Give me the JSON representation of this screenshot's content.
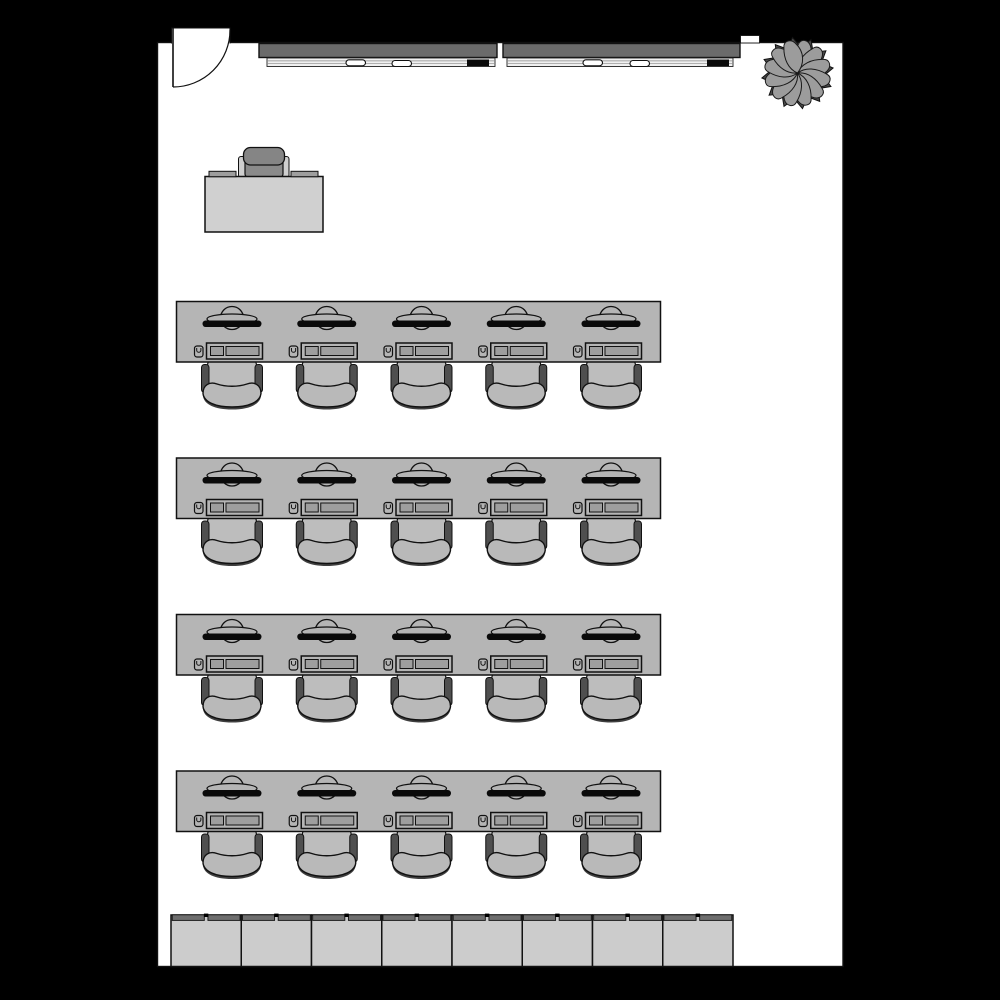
{
  "scene": {
    "title": "Computer classroom floor plan",
    "background_color": "#000000",
    "room_fill": "#ffffff",
    "outline_color": "#111111"
  },
  "palette": {
    "table_gray": "#b5b5b5",
    "desk_gray": "#d0d0d0",
    "seat_gray": "#bdbdbd",
    "crescent_gray": "#b9b9b9",
    "crescent_shadow": "#3f3f3f",
    "armrest_dark": "#4f4f4f",
    "teacher_chair_gray": "#8a8a8a",
    "teacher_armrest": "#cfcfcf",
    "key_gray": "#9e9e9e",
    "board_gray": "#6b6b6b",
    "tray_white": "#f0f0f0",
    "tray_line": "#8a8a8a",
    "cabinet_gray": "#cccccc",
    "cabinet_top": "#6e6e6e",
    "plant_petal": "#9c9c9c",
    "plant_core": "#4a4a4a",
    "marker_white": "#ffffff",
    "eraser_black": "#0a0a0a",
    "monitor_black": "#0a0a0a"
  },
  "room": {
    "door": {
      "name": "entry-door",
      "count": 1,
      "swing": "quarter-arc"
    },
    "plant": {
      "name": "potted-plant",
      "count": 1
    },
    "whiteboards": {
      "count": 2,
      "boards": [
        {
          "name": "whiteboard-left",
          "markers": 2,
          "erasers": 1
        },
        {
          "name": "whiteboard-right",
          "markers": 2,
          "erasers": 1
        }
      ]
    },
    "teacher_area": {
      "desk_count": 1,
      "chair_count": 1,
      "desk_accessories": 2
    },
    "student_rows": {
      "count": 4,
      "stations_per_row": 5,
      "station_equipment": [
        "monitor",
        "keyboard",
        "mouse",
        "chair"
      ],
      "total_stations": 20
    },
    "cabinets": {
      "count": 8,
      "doors_per_cabinet": 2
    }
  }
}
